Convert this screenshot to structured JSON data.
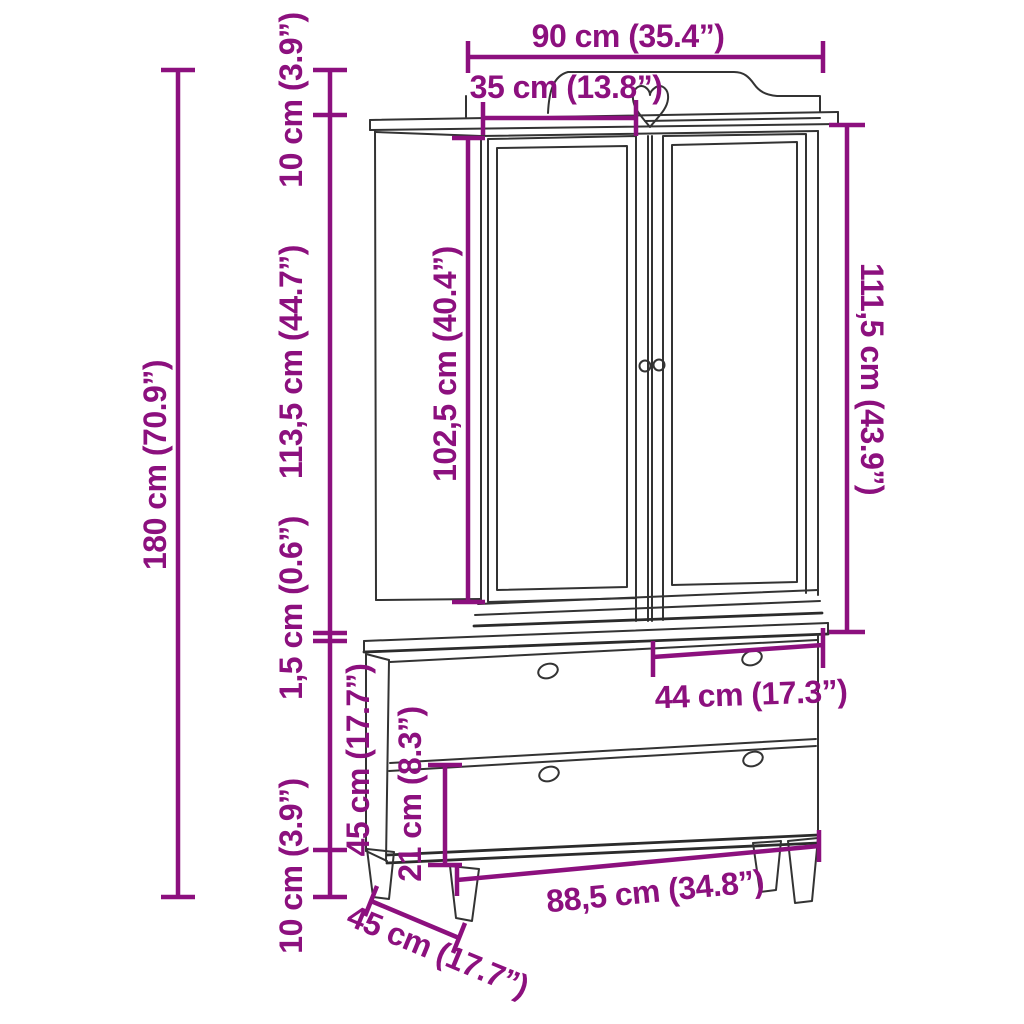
{
  "diagram": {
    "type": "furniture-dimension-diagram",
    "subject": "wardrobe-with-two-doors-and-two-drawers",
    "colors": {
      "dimension_accent": "#8C107E",
      "line_art": "#333333",
      "background": "#FFFFFF"
    },
    "labels": {
      "width_top": "90 cm (35.4”)",
      "depth_upper": "35 cm (13.8”)",
      "crown_height": "10 cm (3.9”)",
      "upper_body_height": "113,5 cm (44.7”)",
      "door_height": "102,5 cm (40.4”)",
      "upper_right_height": "111,5 cm (43.9”)",
      "gap_height": "1,5 cm (0.6”)",
      "lower_unit_height": "45 cm (17.7”)",
      "leg_height": "10 cm (3.9”)",
      "total_height": "180 cm (70.9”)",
      "drawer_width": "44 cm (17.3”)",
      "drawer_front_height": "21 cm (8.3”)",
      "lower_width": "88,5 cm (34.8”)",
      "depth_lower": "45 cm (17.7”)"
    }
  }
}
